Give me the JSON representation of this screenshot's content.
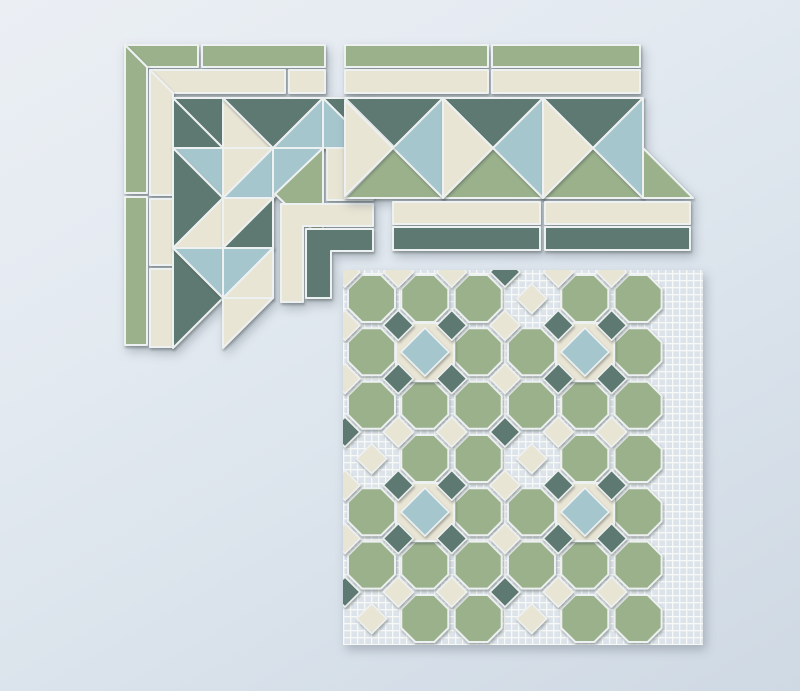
{
  "scene": {
    "kind": "photograph",
    "subject": "three ceramic mosaic tile pieces laid on a pale blue-grey surface",
    "width": 800,
    "height": 691
  },
  "palette": {
    "sage": "#9ab18c",
    "cream": "#e9e5d5",
    "teal": "#5d7971",
    "blue": "#a6c6ce",
    "grout": "#eef1f1",
    "mesh_base": "#dce3ea",
    "mesh_line": "#f7f9f7",
    "bg_light": "#ebeff4",
    "bg_dark": "#cfd9e3"
  },
  "corner_piece": {
    "label": "mitered corner border segment",
    "tiles": [
      {
        "c": "sage",
        "pts": [
          [
            125,
            45
          ],
          [
            198,
            45
          ],
          [
            198,
            67
          ],
          [
            147,
            67
          ]
        ]
      },
      {
        "c": "sage",
        "pts": [
          [
            202,
            45
          ],
          [
            325,
            45
          ],
          [
            325,
            67
          ],
          [
            202,
            67
          ]
        ]
      },
      {
        "c": "sage",
        "pts": [
          [
            125,
            45
          ],
          [
            147,
            67
          ],
          [
            147,
            193
          ],
          [
            125,
            193
          ]
        ]
      },
      {
        "c": "sage",
        "pts": [
          [
            125,
            197
          ],
          [
            147,
            197
          ],
          [
            147,
            345
          ],
          [
            125,
            345
          ]
        ]
      },
      {
        "c": "cream",
        "pts": [
          [
            150,
            70
          ],
          [
            285,
            70
          ],
          [
            285,
            93
          ],
          [
            173,
            93
          ]
        ]
      },
      {
        "c": "cream",
        "pts": [
          [
            289,
            70
          ],
          [
            325,
            70
          ],
          [
            325,
            93
          ],
          [
            289,
            93
          ]
        ]
      },
      {
        "c": "cream",
        "pts": [
          [
            150,
            70
          ],
          [
            173,
            93
          ],
          [
            173,
            195
          ],
          [
            150,
            195
          ]
        ]
      },
      {
        "c": "cream",
        "pts": [
          [
            150,
            199
          ],
          [
            173,
            199
          ],
          [
            173,
            265
          ],
          [
            150,
            265
          ]
        ]
      },
      {
        "c": "cream",
        "pts": [
          [
            150,
            269
          ],
          [
            173,
            269
          ],
          [
            173,
            347
          ],
          [
            150,
            347
          ]
        ]
      },
      {
        "c": "teal",
        "pts": [
          [
            173,
            98
          ],
          [
            223,
            98
          ],
          [
            223,
            148
          ]
        ]
      },
      {
        "c": "teal",
        "pts": [
          [
            173,
            98
          ],
          [
            223,
            148
          ],
          [
            173,
            148
          ]
        ]
      },
      {
        "c": "cream",
        "pts": [
          [
            223,
            98
          ],
          [
            273,
            148
          ],
          [
            223,
            148
          ]
        ]
      },
      {
        "c": "teal",
        "pts": [
          [
            223,
            98
          ],
          [
            323,
            98
          ],
          [
            273,
            148
          ]
        ]
      },
      {
        "c": "blue",
        "pts": [
          [
            323,
            98
          ],
          [
            323,
            148
          ],
          [
            273,
            148
          ]
        ]
      },
      {
        "c": "teal",
        "pts": [
          [
            323,
            98
          ],
          [
            373,
            98
          ],
          [
            373,
            148
          ]
        ]
      },
      {
        "c": "blue",
        "pts": [
          [
            323,
            98
          ],
          [
            373,
            148
          ],
          [
            323,
            148
          ]
        ]
      },
      {
        "c": "blue",
        "pts": [
          [
            173,
            148
          ],
          [
            223,
            148
          ],
          [
            223,
            198
          ]
        ]
      },
      {
        "c": "teal",
        "pts": [
          [
            173,
            148
          ],
          [
            173,
            248
          ],
          [
            223,
            198
          ]
        ]
      },
      {
        "c": "cream",
        "pts": [
          [
            223,
            148
          ],
          [
            273,
            148
          ],
          [
            223,
            198
          ]
        ]
      },
      {
        "c": "blue",
        "pts": [
          [
            273,
            148
          ],
          [
            273,
            198
          ],
          [
            223,
            198
          ]
        ]
      },
      {
        "c": "blue",
        "pts": [
          [
            273,
            148
          ],
          [
            323,
            148
          ],
          [
            273,
            198
          ]
        ]
      },
      {
        "c": "cream",
        "pts": [
          [
            327,
            148
          ],
          [
            373,
            148
          ],
          [
            373,
            200
          ],
          [
            327,
            200
          ]
        ]
      },
      {
        "c": "sage",
        "pts": [
          [
            323,
            148
          ],
          [
            323,
            240
          ],
          [
            275,
            194
          ]
        ]
      },
      {
        "c": "cream",
        "pts": [
          [
            281,
            204
          ],
          [
            373,
            204
          ],
          [
            373,
            226
          ],
          [
            303,
            226
          ],
          [
            303,
            302
          ],
          [
            281,
            302
          ]
        ]
      },
      {
        "c": "teal",
        "pts": [
          [
            306,
            229
          ],
          [
            373,
            229
          ],
          [
            373,
            251
          ],
          [
            331,
            251
          ],
          [
            331,
            298
          ],
          [
            306,
            298
          ]
        ]
      },
      {
        "c": "cream",
        "pts": [
          [
            223,
            198
          ],
          [
            223,
            248
          ],
          [
            173,
            248
          ]
        ]
      },
      {
        "c": "cream",
        "pts": [
          [
            223,
            198
          ],
          [
            273,
            198
          ],
          [
            223,
            248
          ]
        ]
      },
      {
        "c": "teal",
        "pts": [
          [
            273,
            198
          ],
          [
            273,
            248
          ],
          [
            223,
            248
          ]
        ]
      },
      {
        "c": "teal",
        "pts": [
          [
            173,
            248
          ],
          [
            173,
            348
          ],
          [
            223,
            298
          ]
        ]
      },
      {
        "c": "blue",
        "pts": [
          [
            173,
            248
          ],
          [
            223,
            248
          ],
          [
            223,
            298
          ]
        ]
      },
      {
        "c": "blue",
        "pts": [
          [
            223,
            248
          ],
          [
            273,
            248
          ],
          [
            223,
            298
          ]
        ]
      },
      {
        "c": "cream",
        "pts": [
          [
            273,
            248
          ],
          [
            273,
            298
          ],
          [
            223,
            298
          ]
        ]
      },
      {
        "c": "cream",
        "pts": [
          [
            223,
            298
          ],
          [
            273,
            298
          ],
          [
            223,
            348
          ]
        ]
      }
    ]
  },
  "border_strip": {
    "label": "straight zigzag border segment",
    "tiles": [
      {
        "c": "sage",
        "pts": [
          [
            345,
            45
          ],
          [
            488,
            45
          ],
          [
            488,
            67
          ],
          [
            345,
            67
          ]
        ]
      },
      {
        "c": "sage",
        "pts": [
          [
            492,
            45
          ],
          [
            640,
            45
          ],
          [
            640,
            67
          ],
          [
            492,
            67
          ]
        ]
      },
      {
        "c": "cream",
        "pts": [
          [
            345,
            70
          ],
          [
            488,
            70
          ],
          [
            488,
            93
          ],
          [
            345,
            93
          ]
        ]
      },
      {
        "c": "cream",
        "pts": [
          [
            492,
            70
          ],
          [
            640,
            70
          ],
          [
            640,
            93
          ],
          [
            492,
            93
          ]
        ]
      },
      {
        "c": "teal",
        "pts": [
          [
            345,
            98
          ],
          [
            443,
            98
          ],
          [
            394,
            147
          ]
        ]
      },
      {
        "c": "teal",
        "pts": [
          [
            443,
            98
          ],
          [
            543,
            98
          ],
          [
            493,
            148
          ]
        ]
      },
      {
        "c": "teal",
        "pts": [
          [
            543,
            98
          ],
          [
            643,
            98
          ],
          [
            593,
            148
          ]
        ]
      },
      {
        "c": "sage",
        "pts": [
          [
            345,
            198
          ],
          [
            393,
            148
          ],
          [
            443,
            198
          ]
        ]
      },
      {
        "c": "sage",
        "pts": [
          [
            443,
            198
          ],
          [
            493,
            148
          ],
          [
            543,
            198
          ]
        ]
      },
      {
        "c": "sage",
        "pts": [
          [
            543,
            198
          ],
          [
            593,
            148
          ],
          [
            643,
            198
          ]
        ]
      },
      {
        "c": "blue",
        "pts": [
          [
            443,
            98
          ],
          [
            443,
            198
          ],
          [
            393,
            148
          ]
        ]
      },
      {
        "c": "cream",
        "pts": [
          [
            443,
            98
          ],
          [
            493,
            148
          ],
          [
            443,
            198
          ]
        ]
      },
      {
        "c": "blue",
        "pts": [
          [
            543,
            98
          ],
          [
            543,
            198
          ],
          [
            493,
            148
          ]
        ]
      },
      {
        "c": "cream",
        "pts": [
          [
            543,
            98
          ],
          [
            593,
            148
          ],
          [
            543,
            198
          ]
        ]
      },
      {
        "c": "cream",
        "pts": [
          [
            345,
            100
          ],
          [
            393,
            148
          ],
          [
            345,
            196
          ]
        ]
      },
      {
        "c": "blue",
        "pts": [
          [
            643,
            98
          ],
          [
            643,
            198
          ],
          [
            593,
            148
          ]
        ]
      },
      {
        "c": "sage",
        "pts": [
          [
            643,
            148
          ],
          [
            693,
            198
          ],
          [
            643,
            198
          ]
        ]
      },
      {
        "c": "cream",
        "pts": [
          [
            393,
            202
          ],
          [
            540,
            202
          ],
          [
            540,
            224
          ],
          [
            393,
            224
          ]
        ]
      },
      {
        "c": "cream",
        "pts": [
          [
            545,
            202
          ],
          [
            690,
            202
          ],
          [
            690,
            224
          ],
          [
            545,
            224
          ]
        ]
      },
      {
        "c": "teal",
        "pts": [
          [
            393,
            227
          ],
          [
            540,
            227
          ],
          [
            540,
            250
          ],
          [
            393,
            250
          ]
        ]
      },
      {
        "c": "teal",
        "pts": [
          [
            545,
            227
          ],
          [
            690,
            227
          ],
          [
            690,
            250
          ],
          [
            545,
            250
          ]
        ]
      }
    ]
  },
  "field_sheet": {
    "label": "octagon-and-dot field mosaic on mesh backing",
    "origin": [
      345,
      272
    ],
    "pitch": 53.33,
    "cols": 6,
    "rows": 7,
    "octagon_inset": 3,
    "octagon_size": 47,
    "octagon_cut": 14,
    "frame_slots": [
      [
        1,
        1
      ],
      [
        4,
        1
      ],
      [
        1,
        4
      ],
      [
        4,
        4
      ]
    ],
    "chain_slots": [
      [
        3,
        0
      ],
      [
        0,
        3
      ],
      [
        3,
        3
      ],
      [
        3,
        6
      ],
      [
        0,
        6
      ]
    ],
    "frame_half": 29,
    "blue_half": 24,
    "diamond_half": 15,
    "chain_offset": 26.7,
    "mesh": {
      "x": 343,
      "y": 270,
      "w": 360,
      "h": 375,
      "pitch": 7,
      "line": 1.3
    }
  }
}
